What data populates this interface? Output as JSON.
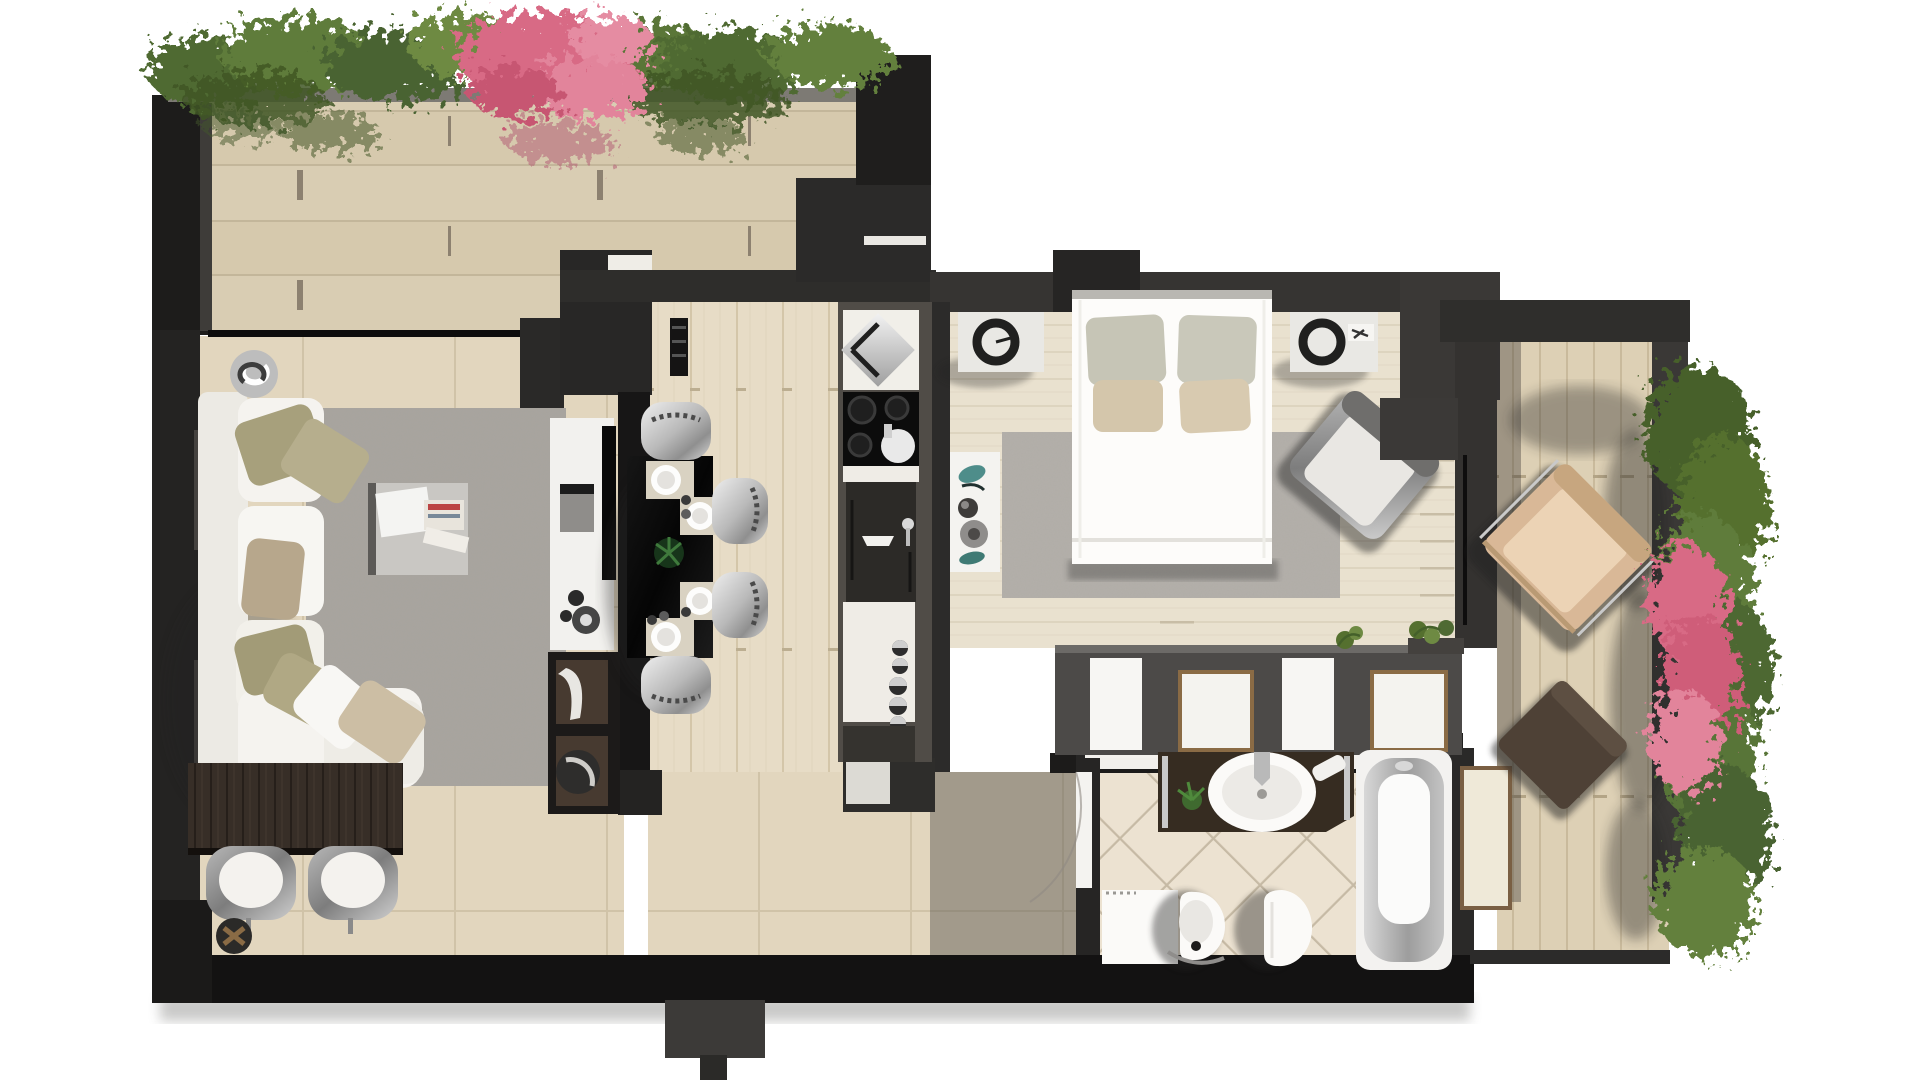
{
  "scene": {
    "kind": "3d-rendered-apartment-floor-plan-top-view",
    "background": "#ffffff"
  },
  "palette": {
    "bg": "#ffffff",
    "wallDark": "#1e1d1c",
    "wallMid": "#33312f",
    "wallSoft": "#4a4745",
    "wallFace": "#5a5document0",
    "terraceTile": "#d9cdb3",
    "terraceGrout": "#c3b69a",
    "terraceTick": "#8d8170",
    "livingTile": "#e2d6be",
    "livingGrout": "#d0c3a8",
    "woodKitchen": "#e7dcc6",
    "woodKitchenLine": "#d4c6a9",
    "woodBedroom": "#e9e1cf",
    "woodBedroomLine": "#d9cfba",
    "deck": "#ddd0b5",
    "deckLine": "#c9ba9c",
    "bathTile": "#ece2d1",
    "bathGrout": "#c6baa5",
    "rugLiving": "#a8a49e",
    "rugBedroom": "#b4b0aa",
    "sofaWhite": "#f5f3ef",
    "sofaShade": "#dedad2",
    "pillowOlive": "#a29b77",
    "pillowOlive2": "#b6ae8d",
    "pillowTaupe": "#b7a78c",
    "pillowBeige": "#ccbea4",
    "pillowSage": "#c6c5b6",
    "wenge": "#372e27",
    "wengeGrain": "#261f1a",
    "blackGloss": "#0b0b0b",
    "chrome": "#c9c9c9",
    "chromeDark": "#8f8f8f",
    "white": "#f7f6f3",
    "offWhite": "#eceae4",
    "counterWhite": "#efece6",
    "prepDark": "#2c2a27",
    "vanity": "#362c21",
    "tubGray": "#aeadac",
    "tanChair": "#d9b democratic root",
    "tan": "#d9b897",
    "tanLight": "#ecd3b5",
    "ottoman": "#4e4136",
    "greenDark": "#3f5626",
    "green1": "#4f6a33",
    "green2": "#5f7c3a",
    "green3": "#6e8a43",
    "green4": "#55702f",
    "pink1": "#d86a85",
    "pink2": "#e2849b",
    "pink3": "#c75672",
    "creamPanel": "#efe9d8",
    "shadow": "#232220"
  },
  "rooms": {
    "terrace_upper": {
      "name": "upper terrace",
      "items": [
        "stone-tile-floor",
        "planter-hedge-green",
        "pink-flowering-shrub",
        "parapet"
      ]
    },
    "living_room": {
      "name": "living room",
      "items": [
        "corner-sofa-white",
        "throw-pillows",
        "area-rug-gray",
        "coffee-table-magazines",
        "round-decor-bowl",
        "tv-cabinet",
        "media-shelves",
        "console-table-wenge",
        "two-dining-chairs",
        "planter-stool"
      ]
    },
    "kitchen": {
      "name": "kitchen / dining",
      "items": [
        "black-bar-table",
        "four-chrome-chairs",
        "four-place-settings",
        "centerpiece-plant",
        "diamond-sink-module",
        "cooktop-four-burners",
        "pot",
        "prep-counter-dark",
        "base-cabinet-knobs",
        "open-door"
      ]
    },
    "bedroom": {
      "name": "bedroom",
      "items": [
        "double-bed-white",
        "two-sage-pillows",
        "two-beige-pillows",
        "nightstand-left",
        "nightstand-right",
        "two-black-lamps",
        "rug-gray",
        "armchair-gray-rotated",
        "decor-console",
        "wardrobe-row-white-panels",
        "wardrobe-plants",
        "wall-desk-dark"
      ]
    },
    "bathroom": {
      "name": "bathroom",
      "items": [
        "vanity-dark-wood",
        "oval-sink-white",
        "faucet-chrome",
        "plant",
        "towel",
        "bathtub",
        "toilet",
        "bidet",
        "shower-tray",
        "diagonal-tile-floor",
        "sliding-door"
      ]
    },
    "terrace_right": {
      "name": "right terrace",
      "items": [
        "wood-deck-planks",
        "lounge-armchair-tan-rotated",
        "ottoman-brown-rotated",
        "climbing-plants-green",
        "climbing-plants-pink",
        "bathtub-side-panel"
      ]
    },
    "hallway": {
      "name": "hallway / entry",
      "items": [
        "tiled-floor",
        "entry-door",
        "wall-niche-white",
        "shelf-unit"
      ]
    }
  }
}
